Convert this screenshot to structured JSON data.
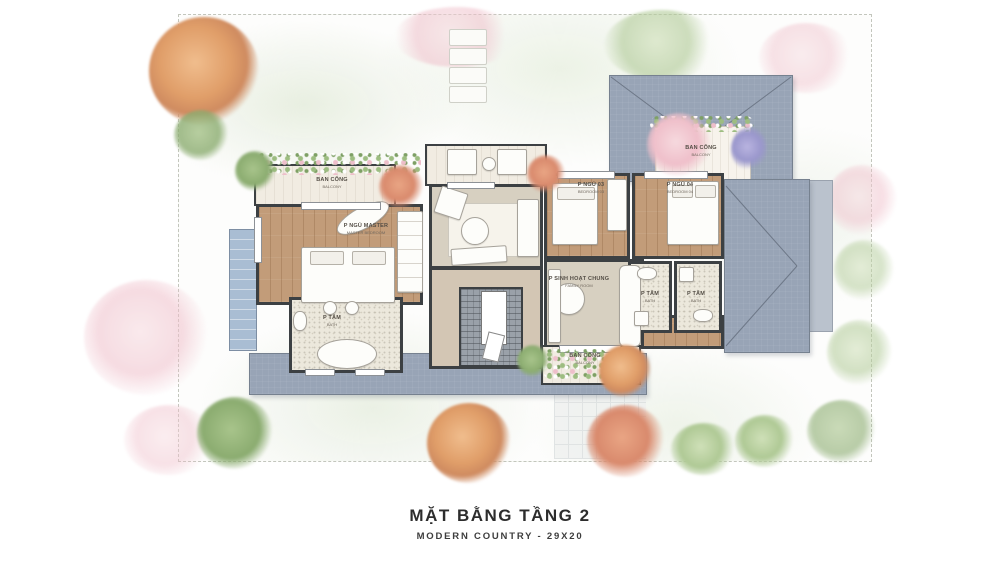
{
  "title": {
    "main": "MẶT BẰNG TẦNG 2",
    "sub": "MODERN COUNTRY - 29X20"
  },
  "rooms": [
    {
      "name": "BAN CÔNG",
      "sub": "BALCONY"
    },
    {
      "name": "P NGỦ MASTER",
      "sub": "MASTER BEDROOM"
    },
    {
      "name": "P TẮM",
      "sub": "BATH"
    },
    {
      "name": "BAN CÔNG",
      "sub": "BALCONY"
    },
    {
      "name": "P NGỦ 03",
      "sub": "BEDROOM 03"
    },
    {
      "name": "P NGỦ 04",
      "sub": "BEDROOM 04"
    },
    {
      "name": "P SINH HOẠT CHUNG",
      "sub": "FAMILY ROOM"
    },
    {
      "name": "P TẮM",
      "sub": "BATH"
    },
    {
      "name": "P TẮM",
      "sub": "BATH"
    },
    {
      "name": "BAN CÔNG",
      "sub": "BALCONY"
    }
  ],
  "colors": {
    "roof": "#98a4b6",
    "roof_light": "#bac2cd",
    "wall": "#3c4043",
    "wood": "#c29c79",
    "tile": "#ece8dc",
    "floor_beige": "#d7d0c1",
    "balcony_floor": "#f1ece2",
    "glass": "#a9bdd3"
  }
}
